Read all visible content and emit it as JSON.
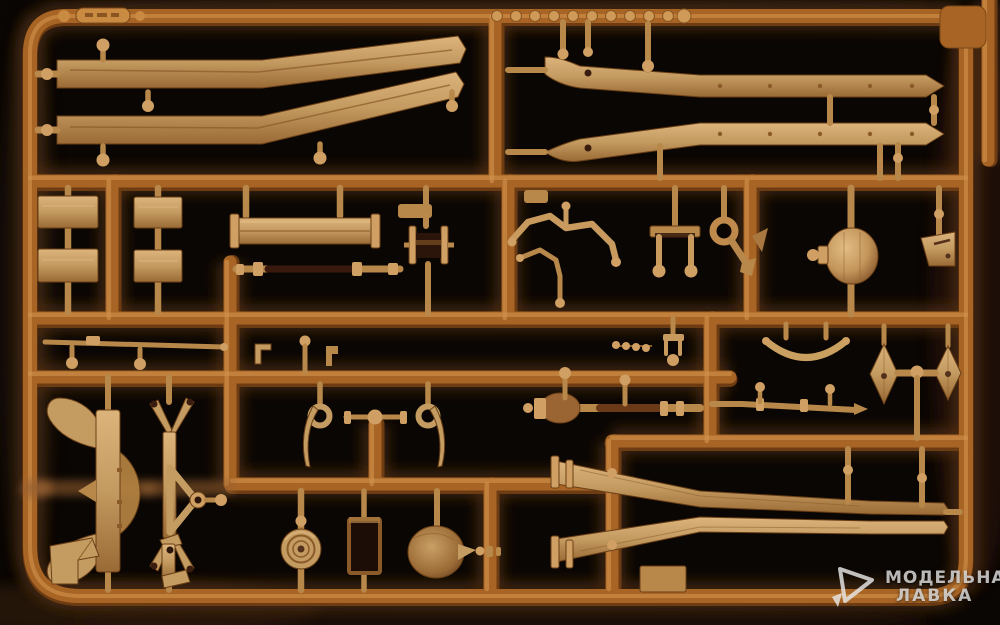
{
  "photo": {
    "subject": "tan injection-molded plastic model kit sprue (parts tree) photographed on a black background",
    "plastic_color": "tan",
    "background_color": "black"
  },
  "watermark": {
    "line1": "МОДЕЛЬНАЯ",
    "line2": "ЛАВКА",
    "logo": "triangle-cursor-icon"
  },
  "palette": {
    "background": "#0a0603",
    "runner_base": "#a86425",
    "runner_highlight": "#d2944e",
    "runner_shadow": "#6e3c12",
    "part_base": "#c39a60",
    "part_highlight": "#e0bb82",
    "part_shadow": "#8a5a28",
    "part_dark": "#2b140a",
    "glow": "#55300f",
    "watermark_text": "rgba(230,230,230,0.8)"
  },
  "parts": [
    "chassis-side-rail-pair-left",
    "chassis-side-rail-pair-right",
    "rivet-disc-row",
    "embossed-part-number-tag",
    "flat-plates-2x2",
    "bumper-beam",
    "segmented-axle-rod",
    "roller-drum",
    "bent-tube-parts",
    "u-bracket-with-balls",
    "tow-hook-ring",
    "differential-dome",
    "wedge-bracket",
    "torsion-bar-rod",
    "small-brackets",
    "bead-strip",
    "clevis-pin",
    "curved-spring-arc",
    "kite-shaped-plates",
    "drive-shaft-with-boot",
    "tapered-axle",
    "shackle-hooks-with-rings",
    "mini-axle-with-ball",
    "cross-member-with-wings",
    "frame-bracket-with-eye",
    "wheel-hub-disc",
    "dark-frame-block",
    "transmission-cone",
    "v-frame-rail-pair",
    "angle-brackets",
    "mushroom-pins"
  ]
}
